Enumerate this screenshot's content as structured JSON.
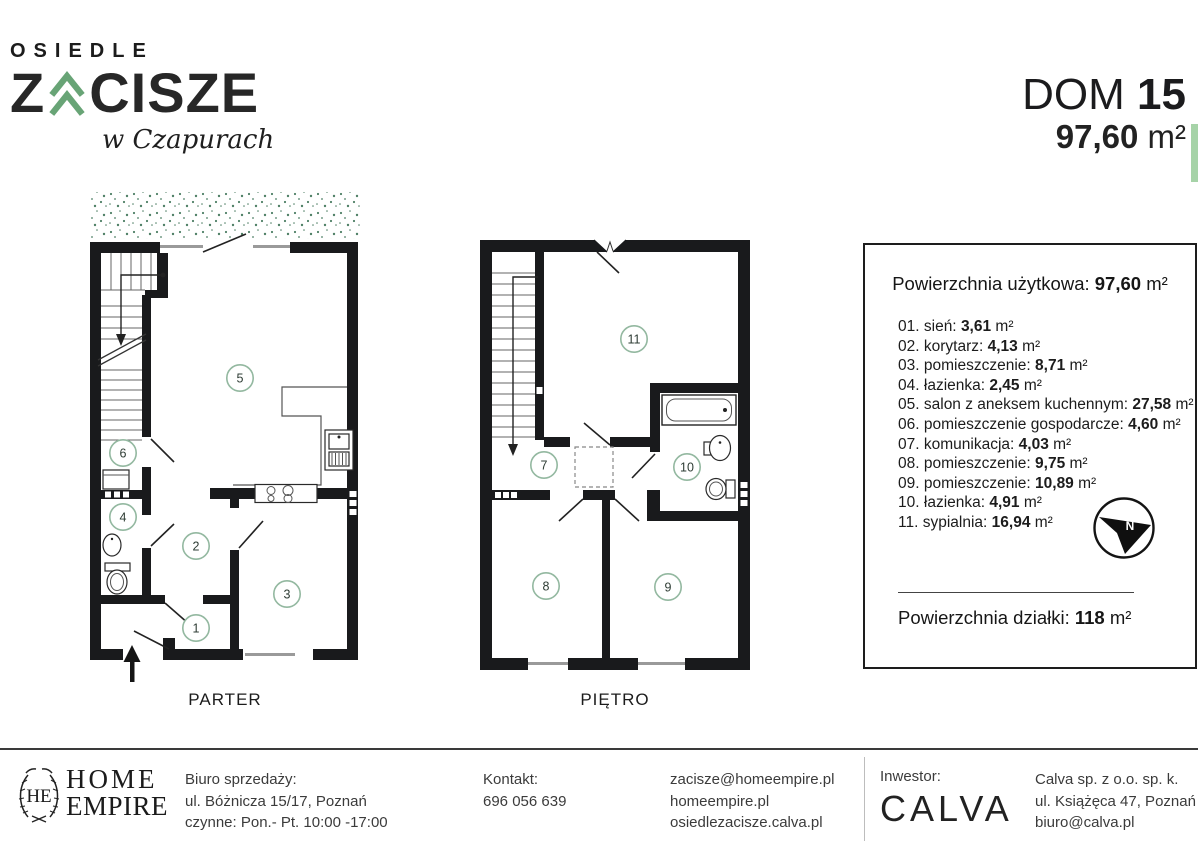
{
  "header": {
    "logo": {
      "top": "OSIEDLE",
      "z": "Z",
      "rest": "CISZE",
      "script": "w Czapurach"
    },
    "dom_label": "DOM",
    "dom_number": "15",
    "area_value": "97,60",
    "area_unit": "m²"
  },
  "plans": {
    "parter": {
      "label": "PARTER",
      "rooms": [
        "1",
        "2",
        "3",
        "4",
        "5",
        "6"
      ]
    },
    "pietro": {
      "label": "PIĘTRO",
      "rooms": [
        "7",
        "8",
        "9",
        "10",
        "11"
      ]
    }
  },
  "panel": {
    "usable_label": "Powierzchnia użytkowa:",
    "usable_value": "97,60",
    "unit": "m²",
    "rooms": [
      {
        "no": "01.",
        "name": "sień:",
        "area": "3,61"
      },
      {
        "no": "02.",
        "name": "korytarz:",
        "area": "4,13"
      },
      {
        "no": "03.",
        "name": "pomieszczenie:",
        "area": "8,71"
      },
      {
        "no": "04.",
        "name": "łazienka:",
        "area": "2,45"
      },
      {
        "no": "05.",
        "name": "salon z aneksem kuchennym:",
        "area": "27,58"
      },
      {
        "no": "06.",
        "name": "pomieszczenie gospodarcze:",
        "area": "4,60"
      },
      {
        "no": "07.",
        "name": "komunikacja:",
        "area": "4,03"
      },
      {
        "no": "08.",
        "name": "pomieszczenie:",
        "area": "9,75"
      },
      {
        "no": "09.",
        "name": "pomieszczenie:",
        "area": "10,89"
      },
      {
        "no": "10.",
        "name": "łazienka:",
        "area": "4,91"
      },
      {
        "no": "11.",
        "name": "sypialnia:",
        "area": "16,94"
      }
    ],
    "compass_n": "N",
    "plot_label": "Powierzchnia działki:",
    "plot_value": "118"
  },
  "footer": {
    "home_empire": {
      "monogram": "HE",
      "name_line1": "HOME",
      "name_line2": "EMPIRE"
    },
    "office": {
      "line1": "Biuro sprzedaży:",
      "line2": "ul. Bóżnicza 15/17, Poznań",
      "line3": "czynne: Pon.- Pt. 10:00 -17:00"
    },
    "contact": {
      "line1": "Kontakt:",
      "line2": "696 056 639"
    },
    "web": {
      "line1": "zacisze@homeempire.pl",
      "line2": "homeempire.pl",
      "line3": "osiedlezacisze.calva.pl"
    },
    "investor": {
      "label": "Inwestor:",
      "name": "CALVA"
    },
    "investor_details": {
      "line1": "Calva sp. z o.o. sp. k.",
      "line2": "ul. Książęca 47, Poznań",
      "line3": "biuro@calva.pl"
    }
  },
  "colors": {
    "logo_green": "#68a476",
    "room_circle_green": "#93b8a0",
    "terrace_dots_green": "#4f8066",
    "accent_bar_green": "#a6d3a8",
    "wall_black": "#191a1c"
  }
}
